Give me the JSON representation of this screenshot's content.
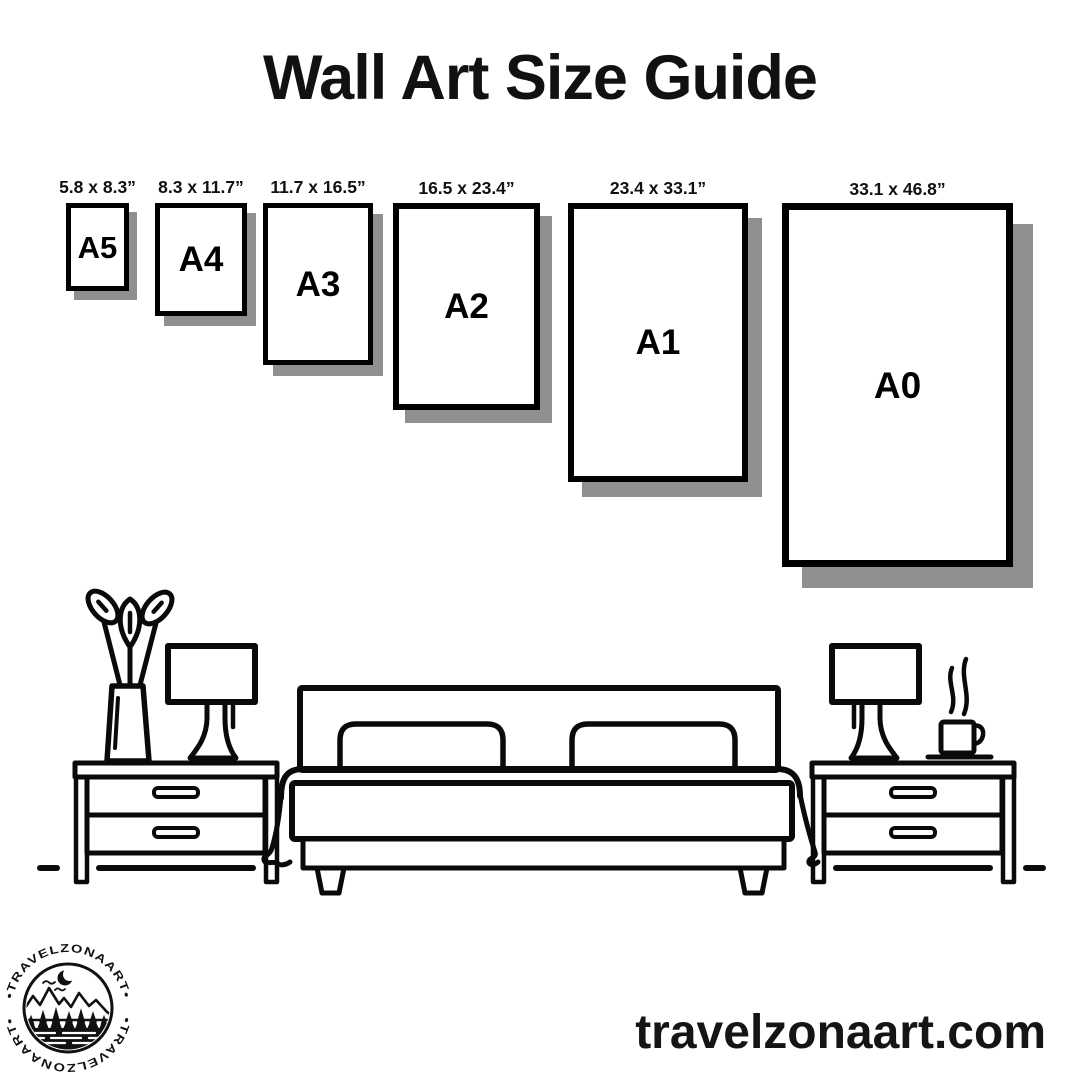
{
  "colors": {
    "background": "#ffffff",
    "ink": "#000000",
    "frame_shadow": "#8f8f8f"
  },
  "title": "Wall Art Size Guide",
  "size_guide": {
    "frames": [
      {
        "name": "A5",
        "dimensions": "5.8 x 8.3”"
      },
      {
        "name": "A4",
        "dimensions": "8.3 x 11.7”"
      },
      {
        "name": "A3",
        "dimensions": "11.7 x 16.5”"
      },
      {
        "name": "A2",
        "dimensions": "16.5 x 23.4”"
      },
      {
        "name": "A1",
        "dimensions": "23.4 x 33.1”"
      },
      {
        "name": "A0",
        "dimensions": "33.1 x 46.8”"
      }
    ]
  },
  "scene": {
    "icons": [
      "flower-vase-icon",
      "table-lamp-icon",
      "nightstand-icon",
      "bed-icon",
      "pillow-icon",
      "blanket-icon",
      "steam-icon",
      "coffee-cup-icon",
      "floor-line"
    ]
  },
  "footer": {
    "website": "travelzonaart.com",
    "logo": {
      "brand_top": "•TRAVELZONAART•",
      "brand_bottom": "•TRAVELZONAART•",
      "icons": [
        "moon-icon",
        "birds-icon",
        "mountains-icon",
        "pine-trees-icon",
        "lake-icon"
      ]
    }
  }
}
